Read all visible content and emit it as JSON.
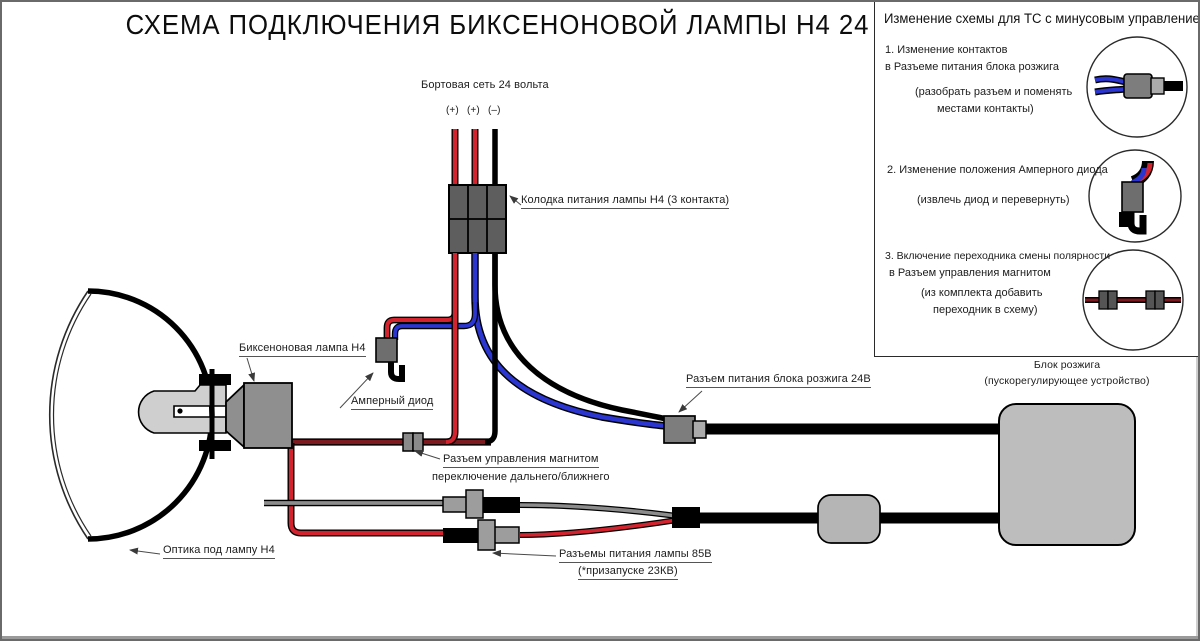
{
  "title": "СХЕМА ПОДКЛЮЧЕНИЯ БИКСЕНОНОВОЙ ЛАМПЫ H4 24 ВОЛЬТА",
  "panel": {
    "header": "Изменение схемы для ТС с минусовым управлением:",
    "items": [
      {
        "lines": [
          "1. Изменение контактов",
          "в Разъеме питания блока розжига"
        ],
        "notes": [
          "(разобрать разъем и поменять",
          "местами контакты)"
        ]
      },
      {
        "lines": [
          "2. Изменение положения Амперного диода"
        ],
        "notes": [
          "(извлечь диод и перевернуть)"
        ]
      },
      {
        "lines": [
          "3. Включение переходника смены полярности",
          "в Разъем управления магнитом"
        ],
        "notes": [
          "(из комплекта добавить",
          "переходник в схему)"
        ]
      }
    ]
  },
  "diagram": {
    "power_net": "Бортовая сеть 24 вольта",
    "terminals": {
      "plus1": "(+)",
      "plus2": "(+)",
      "minus": "(–)"
    },
    "labels": {
      "connector_block": "Колодка питания лампы H4 (3 контакта)",
      "bixenon_lamp": "Биксеноновая лампа H4",
      "ampere_diode": "Амперный диод",
      "magnet_connector_line1": "Разъем управления магнитом",
      "magnet_connector_line2": "переключение дальнего/ближнего",
      "ignition_power_connector": "Разъем питания блока розжига 24В",
      "ballast_line1": "Блок розжига",
      "ballast_line2": "(пускорегулирующее устройство)",
      "lamp_power_line1": "Разъемы питания лампы 85В",
      "lamp_power_line2": "(*призапуске 23КВ)",
      "optics": "Оптика под лампу H4"
    },
    "colors": {
      "wire_red": "#d2232e",
      "wire_dark_red": "#7d1a1f",
      "wire_blue": "#2b35cf",
      "wire_gray": "#8c8c8c",
      "wire_black": "#000000",
      "connector_dark": "#5e5e5e",
      "connector_mid": "#7d7d7d",
      "ballast_gray": "#bdbdbd",
      "lamp_body_gray": "#8f8f8f"
    }
  }
}
